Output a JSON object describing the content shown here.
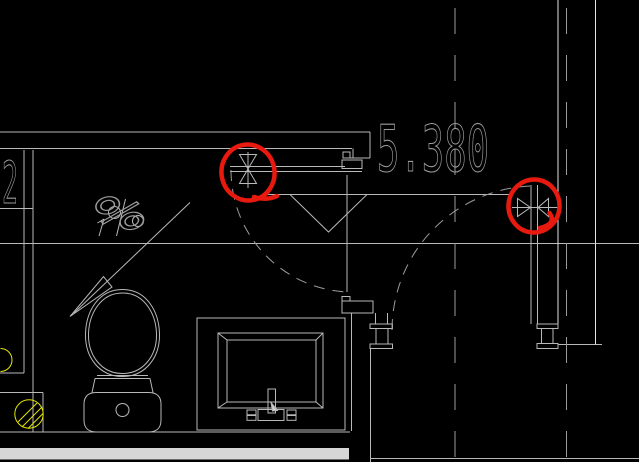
{
  "meta": {
    "type": "cad-floor-plan-detail",
    "background": "#000000"
  },
  "annotations": {
    "elevation": "5.380",
    "axis_number": "2",
    "slope_symbol": "%"
  },
  "palette": {
    "w": "#e4e4e4",
    "g": "#b9b9b9",
    "d": "#9b9b9b",
    "y": "#e6e600",
    "fill_light": "#cfcfcf",
    "band": "#d6d6d6",
    "red": "#e8190f",
    "text": "#9c9c9c"
  },
  "drawing": {
    "solid_lines": [
      [
        0,
        132,
        370,
        132,
        "g"
      ],
      [
        0,
        148.5,
        352,
        148.5,
        "g"
      ],
      [
        230,
        166.5,
        345,
        166.5,
        "g"
      ],
      [
        230,
        171.5,
        362,
        171.5,
        "g"
      ],
      [
        265,
        194.5,
        513,
        194.5,
        "g"
      ],
      [
        512,
        207.5,
        558,
        207.5,
        "g"
      ],
      [
        0,
        208.5,
        33,
        208.5,
        "g"
      ],
      [
        0,
        243.5,
        639,
        243.5,
        "g"
      ],
      [
        558,
        344.5,
        602,
        344.5,
        "g"
      ],
      [
        0,
        373,
        24,
        373,
        "g"
      ],
      [
        0,
        392.5,
        43,
        392.5,
        "g"
      ],
      [
        0,
        432,
        350,
        432,
        "g"
      ],
      [
        370,
        458.5,
        639,
        458.5,
        "g"
      ],
      [
        24,
        150,
        24,
        373,
        "g"
      ],
      [
        33,
        150,
        33,
        432,
        "g"
      ],
      [
        43,
        392.5,
        43,
        432,
        "g"
      ],
      [
        347,
        175,
        347,
        292,
        "g"
      ],
      [
        351.5,
        313,
        351.5,
        431,
        "g"
      ],
      [
        370.5,
        348.5,
        370.5,
        462,
        "g"
      ],
      [
        353,
        148.5,
        353,
        158,
        "g"
      ],
      [
        343,
        158,
        370,
        158,
        "g"
      ],
      [
        370,
        132,
        370,
        158,
        "g"
      ],
      [
        375.5,
        313,
        375.5,
        324,
        "g"
      ],
      [
        387.5,
        313,
        387.5,
        324,
        "g"
      ],
      [
        531,
        185,
        531,
        324,
        "g"
      ],
      [
        537.5,
        185,
        537.5,
        324,
        "g"
      ],
      [
        558,
        0,
        558,
        324,
        "w"
      ],
      [
        595.5,
        0,
        595.5,
        344.5,
        "w"
      ],
      [
        97,
        375.5,
        148,
        375.5,
        "g"
      ],
      [
        95,
        378.5,
        150,
        378.5,
        "g"
      ],
      [
        95,
        378.5,
        92,
        392.5,
        "g"
      ],
      [
        150,
        378.5,
        153,
        392.5,
        "g"
      ],
      [
        248,
        152,
        248,
        188,
        "g"
      ],
      [
        190,
        202.5,
        74,
        313,
        "g"
      ],
      [
        125.5,
        199,
        116.5,
        236,
        "g"
      ],
      [
        99,
        236,
        104,
        219,
        "g"
      ],
      [
        97.5,
        223,
        104,
        219,
        "g"
      ],
      [
        218,
        333,
        227,
        340,
        "g"
      ],
      [
        323,
        333,
        316,
        340,
        "g"
      ],
      [
        218,
        408,
        227,
        402,
        "g"
      ],
      [
        323,
        408,
        316,
        402,
        "g"
      ]
    ],
    "dashed_lines": [
      [
        455,
        8,
        455,
        458,
        "26,21",
        "d"
      ],
      [
        566.5,
        8,
        566.5,
        459,
        "26,21",
        "d"
      ]
    ],
    "rects": [
      [
        370,
        324,
        22.5,
        4.5,
        "g"
      ],
      [
        376,
        328.5,
        12,
        15.5,
        "g"
      ],
      [
        370,
        344,
        22.5,
        4.5,
        "g"
      ],
      [
        537,
        324,
        21,
        4.5,
        "g"
      ],
      [
        541.5,
        328.5,
        11.5,
        15,
        "g"
      ],
      [
        537,
        343.5,
        21,
        5,
        "g"
      ],
      [
        342,
        301,
        31,
        12,
        "g"
      ],
      [
        342,
        296.5,
        8,
        4.5,
        "g"
      ],
      [
        343,
        152,
        7,
        6,
        "g"
      ],
      [
        342,
        160,
        20,
        8.5,
        "g"
      ],
      [
        197,
        318,
        148,
        112,
        "g"
      ],
      [
        218,
        333,
        105,
        75,
        "g"
      ],
      [
        227,
        340,
        89,
        62,
        "g"
      ],
      [
        268,
        389,
        7.5,
        24,
        "g"
      ],
      [
        247,
        410,
        9,
        4.8,
        "g"
      ],
      [
        247,
        415.5,
        9,
        4.8,
        "g"
      ],
      [
        258,
        409.5,
        26,
        11,
        "g"
      ],
      [
        287,
        410,
        9,
        4.8,
        "g"
      ],
      [
        287,
        415.5,
        9,
        4.8,
        "g"
      ]
    ],
    "circles": [
      [
        122.5,
        410,
        6.5,
        "g"
      ],
      [
        114.5,
        212.5,
        6,
        "g"
      ],
      [
        138,
        221,
        5.5,
        "g"
      ],
      [
        29,
        414,
        14.2,
        "y"
      ]
    ],
    "paths": [
      {
        "d": "M122.5,289.5 C147,289.5 159,312 159.5,334 C160,358 145,376.5 122.5,376.5 C100,376.5 85,358 85.5,334 C86,312 98,289.5 122.5,289.5 Z",
        "c": "g"
      },
      {
        "d": "M122.5,293 C144.5,293 156,314 156.5,334 C157,356 143,373.5 122.5,373.5 C102,373.5 88,356 88.5,334 C89,314 100.5,293 122.5,293 Z",
        "c": "g"
      },
      {
        "d": "M96,392.5 L149,392.5 C158,392.5 161,398 161,404 L161,420 C161,429 156,432 148,432 L97,432 C89,432 84,429 84,420 L84,404 C84,398 87,392.5 96,392.5 Z",
        "c": "g"
      },
      {
        "d": "M239.5,154.5 L256.5,154.5 L248,169 Z",
        "c": "g"
      },
      {
        "d": "M239.5,183.5 L256.5,183.5 L248,169 Z",
        "c": "g"
      },
      {
        "d": "M517.5,198.5 L517.5,216.5 L530.5,207.5 Z",
        "c": "g"
      },
      {
        "d": "M548.5,198.5 L548.5,216.5 L538,207.5 Z",
        "c": "g"
      },
      {
        "d": "M290,194.5 L367,194.5 L328.5,232 Z",
        "c": "g"
      },
      {
        "d": "M70,316.5 L103.5,276.5 L112,287 Z",
        "c": "g"
      },
      {
        "d": "M18,422 L37,403 M22,427 L42,407 M28,428.5 L43,413.5",
        "c": "y"
      },
      {
        "d": "M0.5,348.5 A11.5,11.5 0 0 1 0.5,371.5",
        "c": "y"
      },
      {
        "d": "M231,170 A122,122 0 0 0 347,292",
        "c": "d",
        "dash": "11,8"
      },
      {
        "d": "M392,330 A144.5,144.5 0 0 1 531,186",
        "c": "d",
        "dash": "11,8"
      },
      {
        "d": "M271,402.5 L277.5,410.5 L272.5,411 Z",
        "c": "g",
        "fill": "#cfcfcf"
      }
    ],
    "filled_rects": [
      [
        0,
        448,
        349,
        11.5,
        "band"
      ]
    ],
    "red_marks": {
      "ellipses": [
        {
          "cx": 248,
          "cy": 172.5,
          "rx": 26.5,
          "ry": 28,
          "rot": -10
        },
        {
          "cx": 534,
          "cy": 206,
          "rx": 25.5,
          "ry": 26.5,
          "rot": 6
        }
      ],
      "tails": [
        "M254,197 Q266,201 277,196",
        "M549.5,213 Q557,224 540,228"
      ],
      "stroke_width": 4.5
    }
  }
}
